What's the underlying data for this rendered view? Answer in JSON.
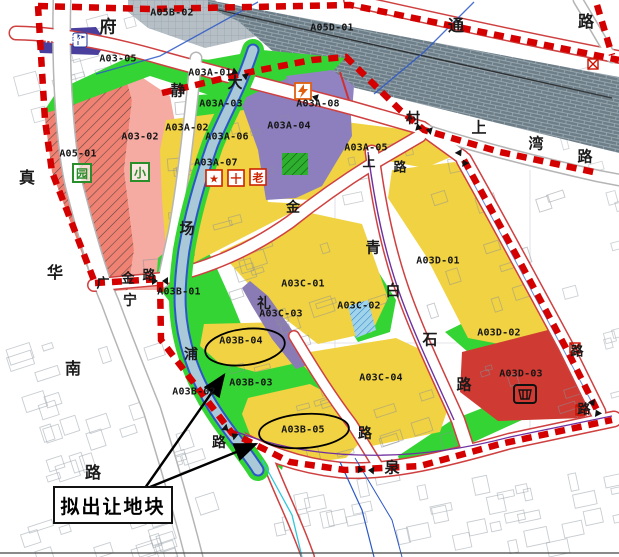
{
  "page": {
    "background": "#ffffff",
    "width": 619,
    "height": 557
  },
  "map": {
    "type": "urban-planning-zoning-map",
    "callout": {
      "label": "拟出让地块"
    },
    "highlighted_parcels": [
      "A03B-04",
      "A03B-05"
    ],
    "parcel_labels": [
      {
        "id": "A05B-02",
        "x": 172,
        "y": 13
      },
      {
        "id": "A05D-01",
        "x": 332,
        "y": 28
      },
      {
        "id": "A03-04",
        "x": 64,
        "y": 40,
        "color": "#ffffff"
      },
      {
        "id": "A03-05",
        "x": 118,
        "y": 59
      },
      {
        "id": "A03A-01",
        "x": 210,
        "y": 73
      },
      {
        "id": "A03A-08",
        "x": 318,
        "y": 104
      },
      {
        "id": "A03A-03",
        "x": 221,
        "y": 104
      },
      {
        "id": "A03A-02",
        "x": 187,
        "y": 128
      },
      {
        "id": "A03A-04",
        "x": 289,
        "y": 126
      },
      {
        "id": "A03A-06",
        "x": 227,
        "y": 137
      },
      {
        "id": "A03-02",
        "x": 140,
        "y": 137
      },
      {
        "id": "A05-01",
        "x": 78,
        "y": 154
      },
      {
        "id": "A03A-05",
        "x": 366,
        "y": 148
      },
      {
        "id": "A03A-07",
        "x": 216,
        "y": 163
      },
      {
        "id": "A03D-01",
        "x": 438,
        "y": 261
      },
      {
        "id": "A03B-01",
        "x": 179,
        "y": 292
      },
      {
        "id": "A03C-01",
        "x": 303,
        "y": 284
      },
      {
        "id": "A03C-02",
        "x": 359,
        "y": 306
      },
      {
        "id": "A03C-03",
        "x": 281,
        "y": 314
      },
      {
        "id": "A03D-02",
        "x": 499,
        "y": 333
      },
      {
        "id": "A03B-04",
        "x": 241,
        "y": 341
      },
      {
        "id": "A03D-03",
        "x": 521,
        "y": 374
      },
      {
        "id": "A03C-04",
        "x": 381,
        "y": 378
      },
      {
        "id": "A03B-03",
        "x": 251,
        "y": 383
      },
      {
        "id": "A03B-02",
        "x": 194,
        "y": 392
      },
      {
        "id": "A03B-05",
        "x": 303,
        "y": 430
      }
    ],
    "road_labels": [
      {
        "char": "府",
        "x": 108,
        "y": 25,
        "size": 17
      },
      {
        "char": "通",
        "x": 456,
        "y": 24,
        "size": 16
      },
      {
        "char": "路",
        "x": 586,
        "y": 20,
        "size": 16
      },
      {
        "char": "静",
        "x": 178,
        "y": 90,
        "size": 15
      },
      {
        "char": "大",
        "x": 235,
        "y": 82,
        "size": 15
      },
      {
        "char": "场",
        "x": 187,
        "y": 228,
        "size": 15
      },
      {
        "char": "金",
        "x": 293,
        "y": 207,
        "size": 14
      },
      {
        "char": "礼",
        "x": 264,
        "y": 303,
        "size": 14
      },
      {
        "char": "青",
        "x": 373,
        "y": 247,
        "size": 15
      },
      {
        "char": "白",
        "x": 393,
        "y": 290,
        "size": 15
      },
      {
        "char": "石",
        "x": 430,
        "y": 339,
        "size": 15
      },
      {
        "char": "路",
        "x": 464,
        "y": 384,
        "size": 15
      },
      {
        "char": "真",
        "x": 27,
        "y": 176,
        "size": 16
      },
      {
        "char": "华",
        "x": 55,
        "y": 271,
        "size": 16
      },
      {
        "char": "南",
        "x": 73,
        "y": 367,
        "size": 16
      },
      {
        "char": "路",
        "x": 93,
        "y": 471,
        "size": 16
      },
      {
        "char": "宁",
        "x": 130,
        "y": 300,
        "size": 14
      },
      {
        "char": "广",
        "x": 103,
        "y": 282,
        "size": 13
      },
      {
        "char": "金",
        "x": 128,
        "y": 277,
        "size": 13
      },
      {
        "char": "路",
        "x": 149,
        "y": 274,
        "size": 13
      },
      {
        "char": "浦",
        "x": 191,
        "y": 354,
        "size": 14
      },
      {
        "char": "路",
        "x": 219,
        "y": 442,
        "size": 14
      },
      {
        "char": "上",
        "x": 479,
        "y": 127,
        "size": 15
      },
      {
        "char": "湾",
        "x": 536,
        "y": 143,
        "size": 15
      },
      {
        "char": "路",
        "x": 585,
        "y": 156,
        "size": 15
      },
      {
        "char": "村",
        "x": 413,
        "y": 118,
        "size": 14
      },
      {
        "char": "上",
        "x": 369,
        "y": 161,
        "size": 13
      },
      {
        "char": "路",
        "x": 400,
        "y": 166,
        "size": 13
      },
      {
        "char": "路",
        "x": 365,
        "y": 433,
        "size": 14
      },
      {
        "char": "泉",
        "x": 392,
        "y": 467,
        "size": 15
      },
      {
        "char": "路",
        "x": 577,
        "y": 350,
        "size": 13
      },
      {
        "char": "路",
        "x": 584,
        "y": 408,
        "size": 13
      }
    ],
    "icons": {
      "kindergarten": {
        "glyph": "园",
        "color": "#2a8f2a"
      },
      "primary_school": {
        "glyph": "小",
        "color": "#2a8f2a"
      },
      "star": {
        "glyph": "★",
        "color": "#cc2200"
      },
      "health": {
        "glyph": "十",
        "color": "#cc2200"
      },
      "elderly": {
        "glyph": "老",
        "color": "#cc2200"
      }
    },
    "colors": {
      "boundary_red": "#d40000",
      "residential_yellow": "#f0d243",
      "green_space": "#35d435",
      "mixed_purple": "#8d7fbd",
      "commercial_red": "#cf3a33",
      "existing_pink": "#f5aaa2",
      "hatched_red": "#ef8273",
      "railway_gray": "#6d7e88",
      "river_blue": "#a9c9d9"
    }
  }
}
